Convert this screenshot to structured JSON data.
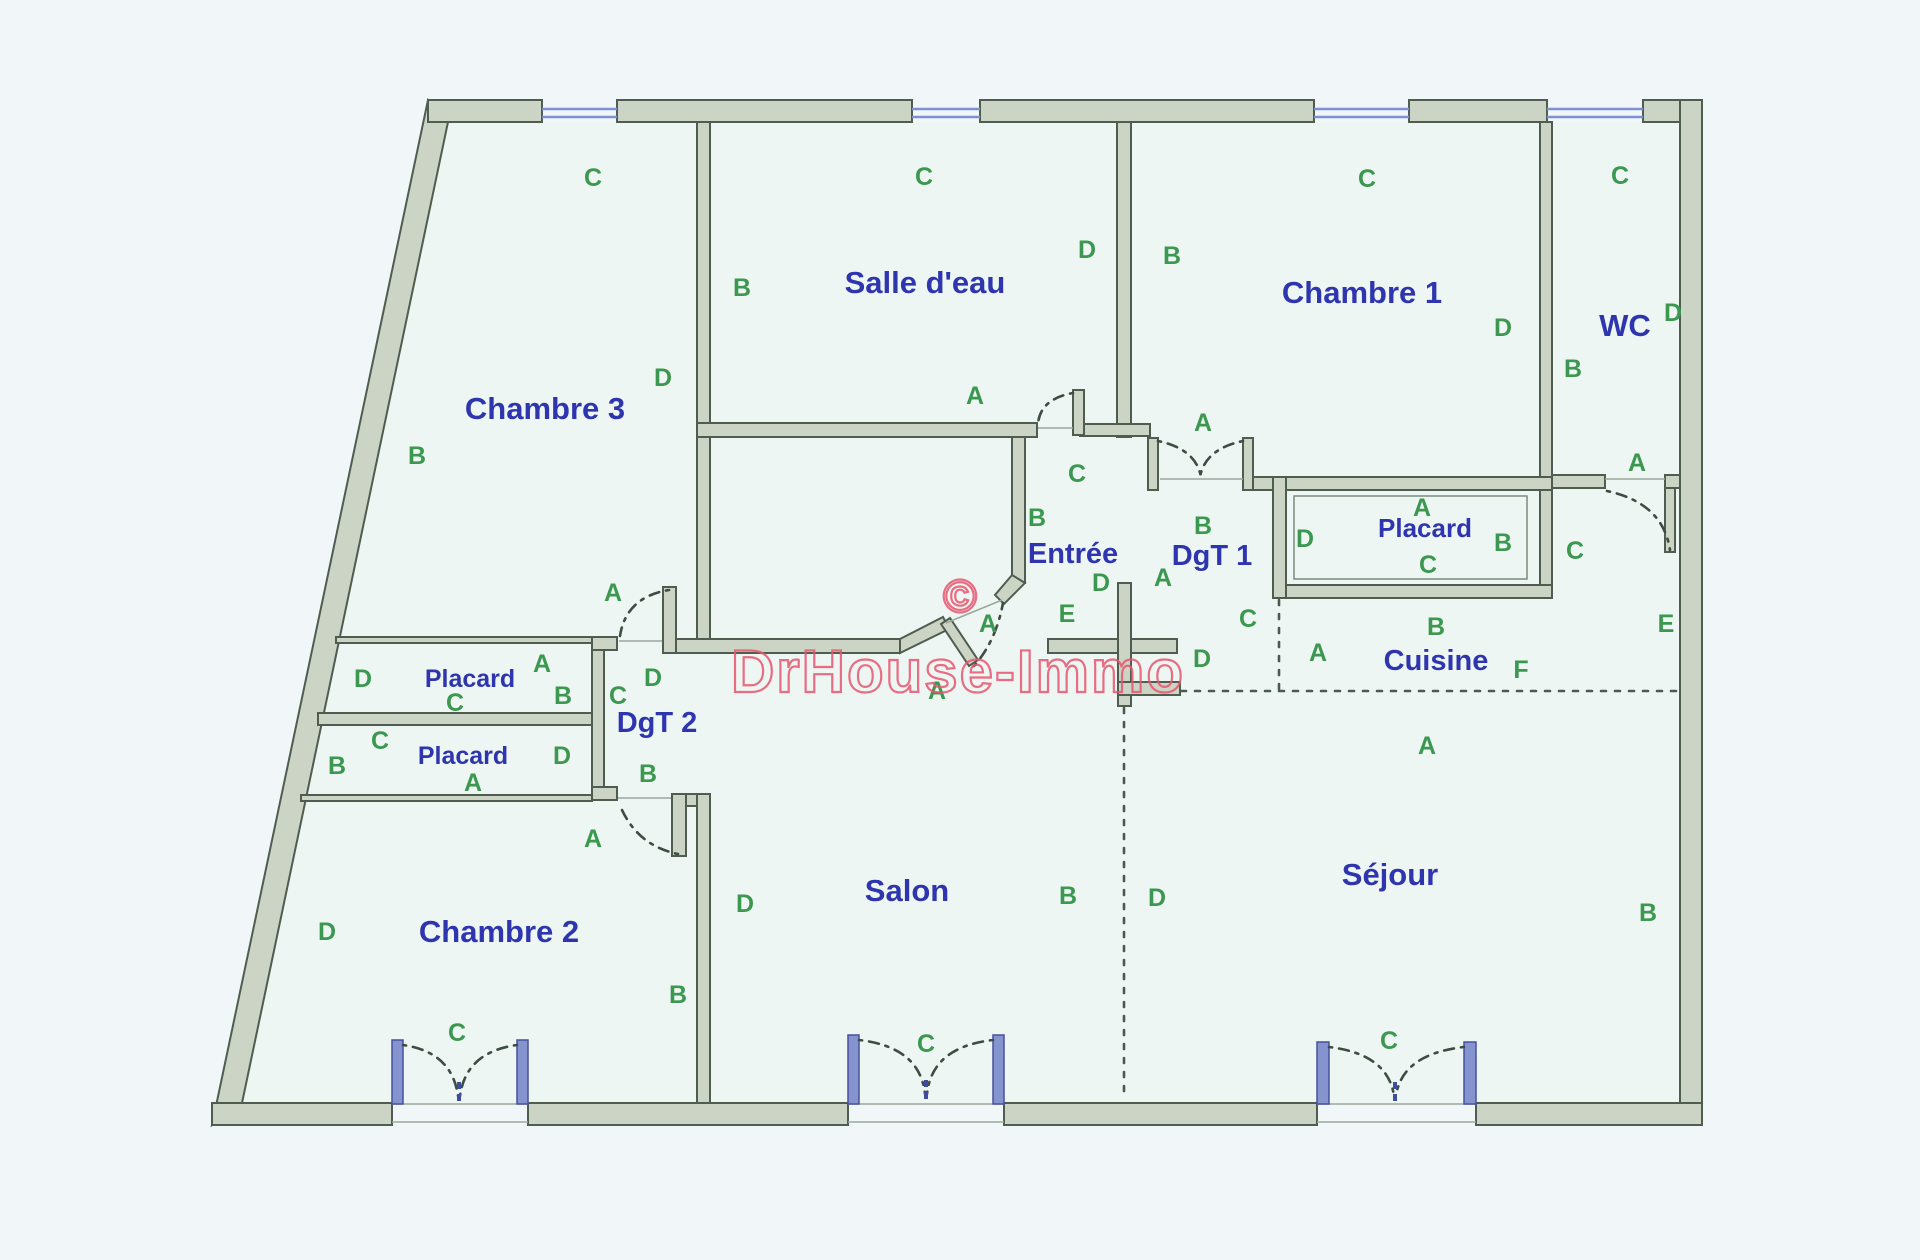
{
  "watermark": {
    "symbol": "©",
    "text": "DrHouse-Immo",
    "color": "#e8566f"
  },
  "colors": {
    "background": "#f1f7f8",
    "floor": "#edf6f2",
    "wall_fill": "#ccd4c6",
    "wall_stroke": "#4f5d50",
    "room_label": "#2e35ae",
    "letter": "#3c9850",
    "window_blue": "#8593cf"
  },
  "rooms": [
    {
      "id": "chambre-3",
      "label": "Chambre 3",
      "x": 545,
      "y": 408,
      "size": 31
    },
    {
      "id": "salle-d-eau",
      "label": "Salle d'eau",
      "x": 925,
      "y": 282,
      "size": 31
    },
    {
      "id": "chambre-1",
      "label": "Chambre 1",
      "x": 1362,
      "y": 292,
      "size": 31
    },
    {
      "id": "wc",
      "label": "WC",
      "x": 1625,
      "y": 325,
      "size": 31
    },
    {
      "id": "entree",
      "label": "Entrée",
      "x": 1073,
      "y": 553,
      "size": 29
    },
    {
      "id": "dgt-1",
      "label": "DgT 1",
      "x": 1212,
      "y": 555,
      "size": 29
    },
    {
      "id": "placard-chambre-1",
      "label": "Placard",
      "x": 1425,
      "y": 528,
      "size": 26
    },
    {
      "id": "cuisine",
      "label": "Cuisine",
      "x": 1436,
      "y": 660,
      "size": 29
    },
    {
      "id": "placard-1",
      "label": "Placard",
      "x": 470,
      "y": 678,
      "size": 25
    },
    {
      "id": "placard-2",
      "label": "Placard",
      "x": 463,
      "y": 755,
      "size": 25
    },
    {
      "id": "dgt-2",
      "label": "DgT 2",
      "x": 657,
      "y": 722,
      "size": 29
    },
    {
      "id": "chambre-2",
      "label": "Chambre 2",
      "x": 499,
      "y": 931,
      "size": 31
    },
    {
      "id": "salon",
      "label": "Salon",
      "x": 907,
      "y": 890,
      "size": 31
    },
    {
      "id": "sejour",
      "label": "Séjour",
      "x": 1390,
      "y": 874,
      "size": 31
    }
  ],
  "letters": [
    {
      "t": "C",
      "x": 593,
      "y": 177
    },
    {
      "t": "C",
      "x": 924,
      "y": 176
    },
    {
      "t": "C",
      "x": 1367,
      "y": 178
    },
    {
      "t": "C",
      "x": 1620,
      "y": 175
    },
    {
      "t": "B",
      "x": 742,
      "y": 287
    },
    {
      "t": "D",
      "x": 1087,
      "y": 249
    },
    {
      "t": "B",
      "x": 1172,
      "y": 255
    },
    {
      "t": "D",
      "x": 1503,
      "y": 327
    },
    {
      "t": "D",
      "x": 1673,
      "y": 312
    },
    {
      "t": "B",
      "x": 1573,
      "y": 368
    },
    {
      "t": "D",
      "x": 663,
      "y": 377
    },
    {
      "t": "A",
      "x": 975,
      "y": 395
    },
    {
      "t": "A",
      "x": 1203,
      "y": 422
    },
    {
      "t": "B",
      "x": 417,
      "y": 455
    },
    {
      "t": "A",
      "x": 1637,
      "y": 462
    },
    {
      "t": "C",
      "x": 1077,
      "y": 473
    },
    {
      "t": "A",
      "x": 1422,
      "y": 507
    },
    {
      "t": "B",
      "x": 1037,
      "y": 517
    },
    {
      "t": "B",
      "x": 1203,
      "y": 525
    },
    {
      "t": "D",
      "x": 1305,
      "y": 538
    },
    {
      "t": "B",
      "x": 1503,
      "y": 542
    },
    {
      "t": "C",
      "x": 1575,
      "y": 550
    },
    {
      "t": "C",
      "x": 1428,
      "y": 564
    },
    {
      "t": "A",
      "x": 1163,
      "y": 577
    },
    {
      "t": "D",
      "x": 1101,
      "y": 582
    },
    {
      "t": "A",
      "x": 613,
      "y": 592
    },
    {
      "t": "E",
      "x": 1067,
      "y": 613
    },
    {
      "t": "C",
      "x": 1248,
      "y": 618
    },
    {
      "t": "A",
      "x": 988,
      "y": 623
    },
    {
      "t": "E",
      "x": 1666,
      "y": 623
    },
    {
      "t": "B",
      "x": 1436,
      "y": 626
    },
    {
      "t": "A",
      "x": 1318,
      "y": 652
    },
    {
      "t": "D",
      "x": 1202,
      "y": 658
    },
    {
      "t": "A",
      "x": 542,
      "y": 663
    },
    {
      "t": "F",
      "x": 1521,
      "y": 669
    },
    {
      "t": "D",
      "x": 363,
      "y": 678
    },
    {
      "t": "D",
      "x": 653,
      "y": 677
    },
    {
      "t": "A",
      "x": 937,
      "y": 690
    },
    {
      "t": "B",
      "x": 563,
      "y": 695
    },
    {
      "t": "C",
      "x": 618,
      "y": 695
    },
    {
      "t": "C",
      "x": 455,
      "y": 702
    },
    {
      "t": "C",
      "x": 380,
      "y": 740
    },
    {
      "t": "A",
      "x": 1427,
      "y": 745
    },
    {
      "t": "D",
      "x": 562,
      "y": 755
    },
    {
      "t": "B",
      "x": 337,
      "y": 765
    },
    {
      "t": "B",
      "x": 648,
      "y": 773
    },
    {
      "t": "A",
      "x": 473,
      "y": 782
    },
    {
      "t": "A",
      "x": 593,
      "y": 838
    },
    {
      "t": "B",
      "x": 1068,
      "y": 895
    },
    {
      "t": "D",
      "x": 1157,
      "y": 897
    },
    {
      "t": "D",
      "x": 745,
      "y": 903
    },
    {
      "t": "B",
      "x": 1648,
      "y": 912
    },
    {
      "t": "D",
      "x": 327,
      "y": 931
    },
    {
      "t": "B",
      "x": 678,
      "y": 994
    },
    {
      "t": "C",
      "x": 457,
      "y": 1032
    },
    {
      "t": "C",
      "x": 926,
      "y": 1043
    },
    {
      "t": "C",
      "x": 1389,
      "y": 1040
    }
  ]
}
